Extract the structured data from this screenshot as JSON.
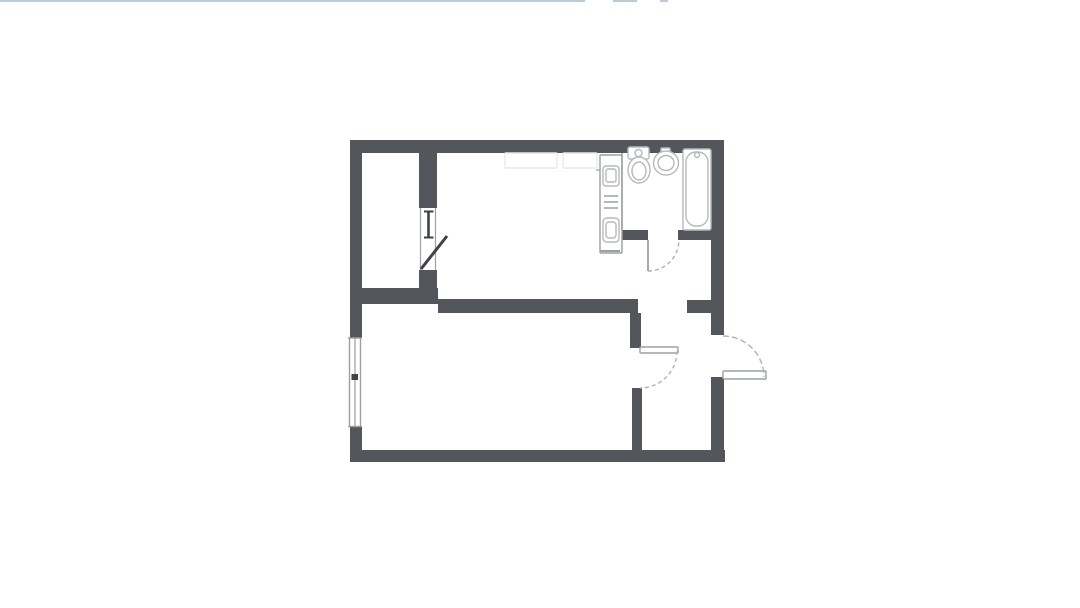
{
  "page": {
    "background": "#ffffff",
    "top_line_color": "#bccadb",
    "top_line_segments": [
      {
        "x": 0,
        "w": 585
      },
      {
        "x": 613,
        "w": 24
      },
      {
        "x": 660,
        "w": 8
      }
    ]
  },
  "palette": {
    "wall": "#53575b",
    "thin": "#9aa0a3",
    "fixture": "#b6babc",
    "dark": "#3f4347",
    "dash": "#b0b4b6",
    "faint": "#e6e9eb"
  },
  "plan": {
    "rooms": [
      {
        "name": "room-area-upper-left",
        "x": 362,
        "y": 153,
        "w": 57,
        "h": 135
      },
      {
        "name": "room-area-kitchen",
        "x": 437,
        "y": 153,
        "w": 186,
        "h": 146
      },
      {
        "name": "room-area-bathroom",
        "x": 623,
        "y": 153,
        "w": 88,
        "h": 77
      },
      {
        "name": "room-area-living",
        "x": 362,
        "y": 313,
        "w": 268,
        "h": 137
      },
      {
        "name": "room-area-hallway",
        "x": 642,
        "y": 313,
        "w": 69,
        "h": 137
      }
    ],
    "walls": [
      {
        "name": "top-wall",
        "x": 350,
        "y": 140,
        "w": 374,
        "h": 13
      },
      {
        "name": "left-wall-upper",
        "x": 350,
        "y": 140,
        "w": 12,
        "h": 164
      },
      {
        "name": "left-wall-mid",
        "x": 350,
        "y": 300,
        "w": 12,
        "h": 38
      },
      {
        "name": "left-wall-lower",
        "x": 350,
        "y": 427,
        "w": 12,
        "h": 35
      },
      {
        "name": "bottom-wall",
        "x": 350,
        "y": 450,
        "w": 375,
        "h": 12
      },
      {
        "name": "right-wall-upper",
        "x": 711,
        "y": 140,
        "w": 13,
        "h": 195
      },
      {
        "name": "right-wall-lower",
        "x": 711,
        "y": 377,
        "w": 13,
        "h": 85
      },
      {
        "name": "closet-partition-upper",
        "x": 419,
        "y": 153,
        "w": 18,
        "h": 55
      },
      {
        "name": "closet-partition-lower",
        "x": 419,
        "y": 270,
        "w": 18,
        "h": 34
      },
      {
        "name": "mid-wall-left",
        "x": 350,
        "y": 288,
        "w": 88,
        "h": 16
      },
      {
        "name": "mid-wall-center",
        "x": 438,
        "y": 299,
        "w": 200,
        "h": 14
      },
      {
        "name": "mid-wall-right-stub",
        "x": 687,
        "y": 300,
        "w": 24,
        "h": 13
      },
      {
        "name": "hallway-wall-upper",
        "x": 630,
        "y": 313,
        "w": 11,
        "h": 35
      },
      {
        "name": "hallway-wall-lower",
        "x": 632,
        "y": 388,
        "w": 10,
        "h": 62
      },
      {
        "name": "bathroom-wall-left-segment",
        "x": 620,
        "y": 230,
        "w": 28,
        "h": 10
      },
      {
        "name": "bathroom-wall-right-segment",
        "x": 678,
        "y": 230,
        "w": 33,
        "h": 10
      }
    ],
    "outline_rects": [
      {
        "name": "kitchen-counter-ghost-a",
        "x": 505,
        "y": 153,
        "w": 52,
        "h": 15,
        "rx": 1,
        "c": "faint",
        "fill": "none"
      },
      {
        "name": "kitchen-counter-ghost-b",
        "x": 563,
        "y": 153,
        "w": 34,
        "h": 15,
        "rx": 1,
        "c": "faint",
        "fill": "none"
      },
      {
        "name": "kitchen-strip-outline",
        "x": 600,
        "y": 155,
        "w": 22,
        "h": 98,
        "rx": 1,
        "c": "thin",
        "fill": "white"
      },
      {
        "name": "kitchen-sink-outer",
        "x": 603,
        "y": 166,
        "w": 16,
        "h": 20,
        "rx": 3,
        "c": "fixture",
        "fill": "white"
      },
      {
        "name": "kitchen-sink-inner",
        "x": 606,
        "y": 169,
        "w": 10,
        "h": 13,
        "rx": 2,
        "c": "fixture",
        "fill": "none"
      },
      {
        "name": "kitchen-appliance-outer",
        "x": 603,
        "y": 218,
        "w": 16,
        "h": 24,
        "rx": 4,
        "c": "fixture",
        "fill": "white"
      },
      {
        "name": "kitchen-appliance-inner",
        "x": 606,
        "y": 222,
        "w": 10,
        "h": 16,
        "rx": 3,
        "c": "fixture",
        "fill": "none"
      },
      {
        "name": "toilet-tank",
        "x": 628,
        "y": 147,
        "w": 21,
        "h": 12,
        "rx": 2,
        "c": "fixture",
        "fill": "white"
      },
      {
        "name": "bathtub-outer",
        "x": 683,
        "y": 149,
        "w": 28,
        "h": 81,
        "rx": 2,
        "c": "fixture",
        "fill": "white"
      },
      {
        "name": "bathtub-inner",
        "x": 686,
        "y": 152,
        "w": 22,
        "h": 74,
        "rx": 10,
        "c": "fixture",
        "fill": "none"
      },
      {
        "name": "basin-tap",
        "x": 661,
        "y": 148,
        "w": 9,
        "h": 5,
        "rx": 1,
        "c": "fixture",
        "fill": "white"
      },
      {
        "name": "hallway-door-leaf",
        "x": 640,
        "y": 347,
        "w": 38,
        "h": 6,
        "rx": 1,
        "c": "thin",
        "fill": "white"
      },
      {
        "name": "entry-door-leaf",
        "x": 723,
        "y": 371,
        "w": 43,
        "h": 8,
        "rx": 1,
        "c": "thin",
        "fill": "white"
      }
    ],
    "ellipses": [
      {
        "name": "toilet-bowl-outer",
        "cx": 639,
        "cy": 170,
        "rx": 11,
        "ry": 13,
        "c": "fixture",
        "fill": "white"
      },
      {
        "name": "toilet-bowl-inner",
        "cx": 639,
        "cy": 171,
        "rx": 7,
        "ry": 9,
        "c": "fixture",
        "fill": "none"
      },
      {
        "name": "toilet-tank-button",
        "cx": 638.5,
        "cy": 153,
        "rx": 3.5,
        "ry": 3.5,
        "c": "fixture",
        "fill": "none"
      },
      {
        "name": "basin-outer",
        "cx": 666,
        "cy": 163,
        "rx": 12.5,
        "ry": 12,
        "c": "fixture",
        "fill": "white"
      },
      {
        "name": "basin-inner",
        "cx": 666,
        "cy": 163,
        "rx": 8,
        "ry": 7.5,
        "c": "fixture",
        "fill": "none"
      },
      {
        "name": "bathtub-tap",
        "cx": 697,
        "cy": 155,
        "rx": 2.5,
        "ry": 2.5,
        "c": "fixture",
        "fill": "none"
      }
    ],
    "thin_lines": [
      {
        "name": "bathroom-partition-line",
        "x1": 622,
        "y1": 153,
        "x2": 622,
        "y2": 230,
        "w": 1.5,
        "c": "thin"
      },
      {
        "name": "balcony-door-frame-left",
        "x1": 420.5,
        "y1": 208,
        "x2": 420.5,
        "y2": 270,
        "w": 1.2,
        "c": "thin"
      },
      {
        "name": "balcony-door-frame-right",
        "x1": 435.5,
        "y1": 208,
        "x2": 435.5,
        "y2": 270,
        "w": 1.2,
        "c": "thin"
      },
      {
        "name": "balcony-window-bar",
        "x1": 428.5,
        "y1": 211,
        "x2": 428.5,
        "y2": 238,
        "w": 2.6,
        "c": "dark"
      },
      {
        "name": "balcony-window-cap-top",
        "x1": 424,
        "y1": 211.5,
        "x2": 433.5,
        "y2": 211.5,
        "w": 2,
        "c": "dark"
      },
      {
        "name": "balcony-window-cap-bottom",
        "x1": 424,
        "y1": 237.5,
        "x2": 433.5,
        "y2": 237.5,
        "w": 2,
        "c": "dark"
      },
      {
        "name": "balcony-door-leaf",
        "x1": 421,
        "y1": 269,
        "x2": 447,
        "y2": 236,
        "w": 3,
        "c": "dark"
      },
      {
        "name": "window-outer-line",
        "x1": 349.5,
        "y1": 338,
        "x2": 349.5,
        "y2": 427,
        "w": 1.4,
        "c": "thin"
      },
      {
        "name": "window-inner-line",
        "x1": 360.5,
        "y1": 338,
        "x2": 360.5,
        "y2": 427,
        "w": 1.4,
        "c": "thin"
      },
      {
        "name": "window-glazing-line",
        "x1": 355,
        "y1": 338,
        "x2": 355,
        "y2": 427,
        "w": 1.2,
        "c": "thin"
      },
      {
        "name": "window-cap-top",
        "x1": 348,
        "y1": 338,
        "x2": 362,
        "y2": 338,
        "w": 1.4,
        "c": "thin"
      },
      {
        "name": "window-cap-bottom",
        "x1": 348,
        "y1": 426.5,
        "x2": 362,
        "y2": 426.5,
        "w": 1.4,
        "c": "thin"
      },
      {
        "name": "window-center-mark",
        "x1": 351.5,
        "y1": 377,
        "x2": 358,
        "y2": 377,
        "w": 6,
        "c": "dark"
      },
      {
        "name": "bathroom-door-leaf",
        "x1": 648,
        "y1": 240,
        "x2": 648,
        "y2": 271,
        "w": 1.8,
        "c": "thin"
      },
      {
        "name": "kitchen-counter-tick",
        "x1": 596,
        "y1": 170,
        "x2": 600,
        "y2": 170,
        "w": 1.2,
        "c": "thin"
      },
      {
        "name": "kitchen-strip-bottom-cap",
        "x1": 600,
        "y1": 251,
        "x2": 620,
        "y2": 251,
        "w": 2,
        "c": "thin"
      },
      {
        "name": "stove-burner-line-1",
        "x1": 604,
        "y1": 196,
        "x2": 618,
        "y2": 196,
        "w": 1.5,
        "c": "thin"
      },
      {
        "name": "stove-burner-line-2",
        "x1": 604,
        "y1": 202,
        "x2": 618,
        "y2": 202,
        "w": 1.5,
        "c": "thin"
      },
      {
        "name": "stove-burner-line-3",
        "x1": 604,
        "y1": 208,
        "x2": 618,
        "y2": 208,
        "w": 1.5,
        "c": "thin"
      }
    ],
    "arcs": [
      {
        "name": "bathroom-door-arc",
        "d": "M 648 271 A 31 31 0 0 0 679 240",
        "c": "dash",
        "w": 1.4,
        "dash": "4 3"
      },
      {
        "name": "hallway-door-arc",
        "d": "M 677 351 A 37 37 0 0 1 640 388",
        "c": "dash",
        "w": 1.4,
        "dash": "4 3"
      },
      {
        "name": "entry-door-arc",
        "d": "M 723 336 A 41 41 0 0 1 764 377",
        "c": "dash",
        "w": 1.4,
        "dash": "6 3"
      }
    ]
  }
}
